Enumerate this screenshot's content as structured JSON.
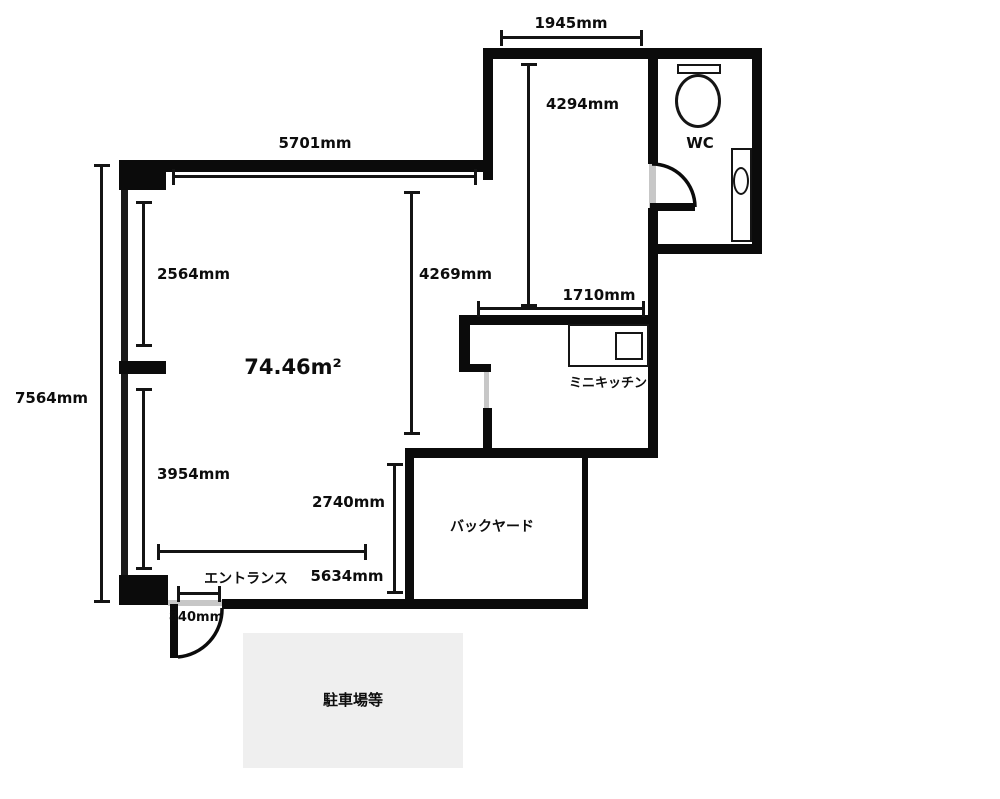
{
  "plan": {
    "area_label": "74.46m²",
    "rooms": {
      "wc": "WC",
      "mini_kitchen": "ミニキッチン",
      "backyard": "バックヤード",
      "entrance": "エントランス",
      "parking": "駐車場等"
    },
    "dimensions": {
      "top_room_width": "1945mm",
      "top_room_depth": "4294mm",
      "main_room_width": "5701mm",
      "window_upper": "2564mm",
      "main_room_depth": "4269mm",
      "overall_depth": "7564mm",
      "kitchen_width": "1710mm",
      "window_lower": "3954mm",
      "backyard_depth": "2740mm",
      "main_bottom_width": "5634mm",
      "entrance_width": "840mm"
    },
    "colors": {
      "wall": "#0b0b0b",
      "opening_line": "#c7c7c7",
      "parking_bg": "#efefef",
      "text": "#0d0d0d",
      "background": "#ffffff"
    }
  }
}
